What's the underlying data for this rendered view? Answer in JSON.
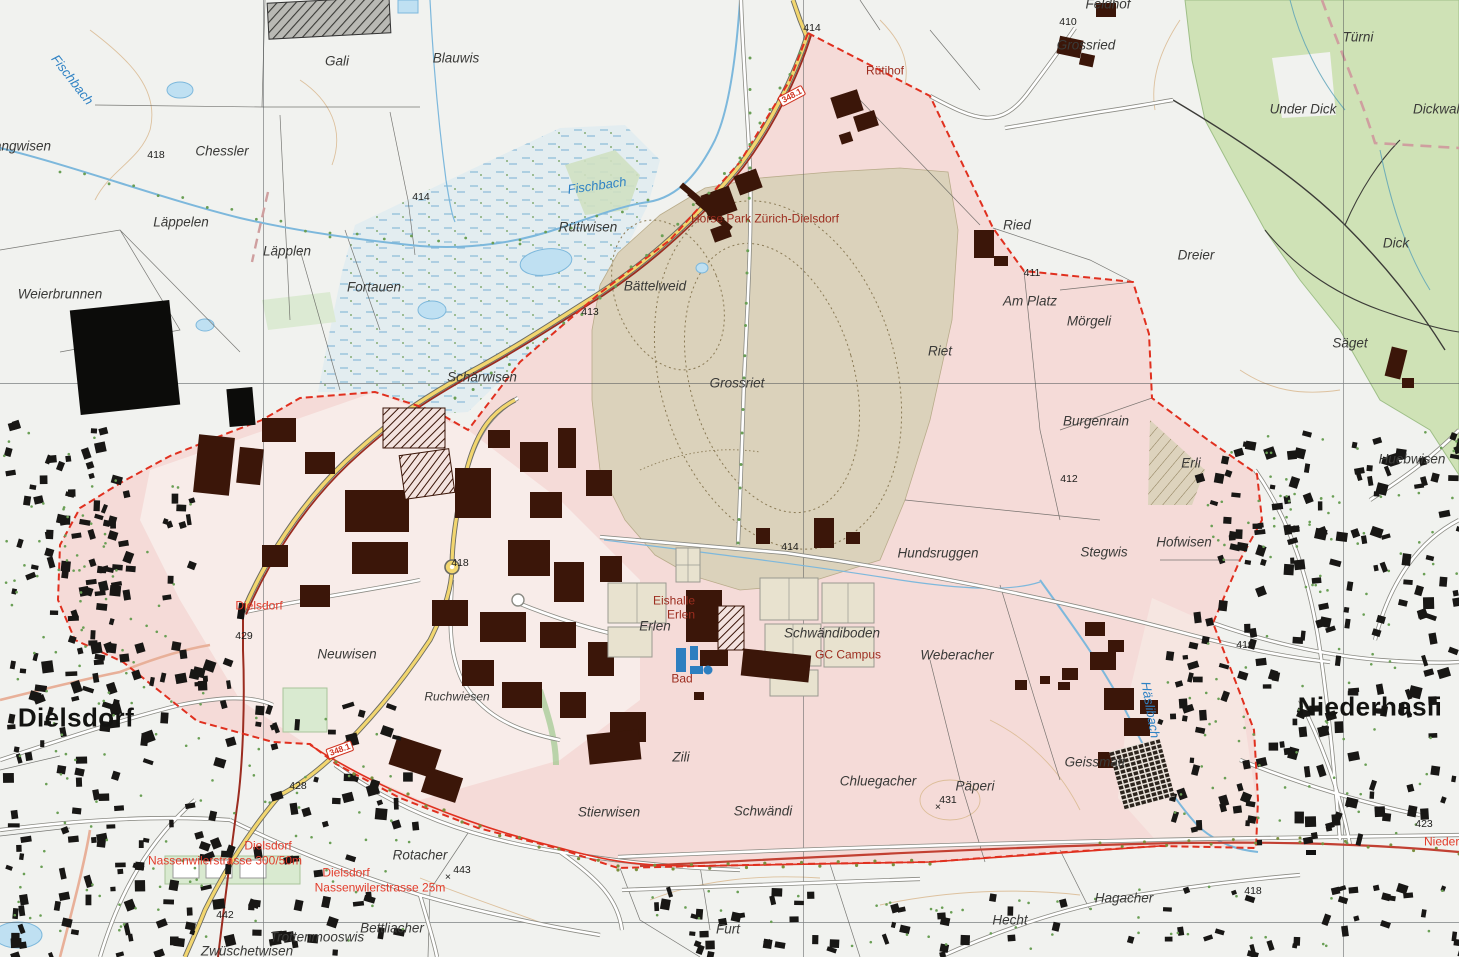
{
  "map": {
    "description": "Swiss national map extract, Dielsdorf / Niederhasli with development zone overlay",
    "colors": {
      "zone_pink": "#f5dbd8",
      "industrial_pink": "#f8ece9",
      "racetrack_tan": "#dbd2bb",
      "forest_green": "#cfe2b6",
      "marsh_blue": "#e3edf0",
      "water_blue": "#7db8dc",
      "building_town": "#181715",
      "building_industrial": "#3b1609",
      "boundary_red": "#e0301f",
      "railway_red": "#9b2c20",
      "road_yellow": "#f2d66f",
      "contour_brown": "#d9b98f",
      "tree_green": "#6a9f55",
      "label_water_blue": "#2f82c4",
      "label_poi_red": "#9c2d1f",
      "label_station_red": "#e23b2a"
    },
    "towns": [
      "Dielsdorf",
      "Niederhasli"
    ],
    "waters": [
      "Fischbach",
      "Häslibach"
    ],
    "pois": [
      "Horse Park Zürich-Dielsdorf",
      "Eishalle Erlen",
      "GC Campus",
      "Bad"
    ],
    "stations": [
      "Dielsdorf",
      "Dielsdorf Nassenwilerstrasse 300/50m",
      "Dielsdorf Nassenwilerstrasse 25m",
      "Niederhasli"
    ],
    "road_shield": "348.1"
  },
  "labels": [
    {
      "text": "angwisen",
      "x": -6,
      "y": 147,
      "cls": "field",
      "anchor": "left"
    },
    {
      "text": "Fischbach",
      "x": 72,
      "y": 80,
      "cls": "water",
      "rot": 52
    },
    {
      "text": "Gali",
      "x": 337,
      "y": 62,
      "cls": "field"
    },
    {
      "text": "Blauwis",
      "x": 456,
      "y": 59,
      "cls": "field"
    },
    {
      "text": "Chessler",
      "x": 222,
      "y": 152,
      "cls": "field"
    },
    {
      "text": "418",
      "x": 156,
      "y": 156,
      "cls": "elev"
    },
    {
      "text": "414",
      "x": 421,
      "y": 198,
      "cls": "elev"
    },
    {
      "text": "Läppelen",
      "x": 181,
      "y": 223,
      "cls": "field"
    },
    {
      "text": "Läpplen",
      "x": 287,
      "y": 252,
      "cls": "field"
    },
    {
      "text": "Weierbrunnen",
      "x": 60,
      "y": 295,
      "cls": "field"
    },
    {
      "text": "Fortauen",
      "x": 374,
      "y": 288,
      "cls": "field"
    },
    {
      "text": "Rütiwisen",
      "x": 588,
      "y": 228,
      "cls": "field"
    },
    {
      "text": "Fischbach",
      "x": 597,
      "y": 186,
      "cls": "water",
      "rot": -8
    },
    {
      "text": "Bättelweid",
      "x": 655,
      "y": 287,
      "cls": "field"
    },
    {
      "text": "413",
      "x": 590,
      "y": 313,
      "cls": "elev"
    },
    {
      "text": "Schärwisen",
      "x": 482,
      "y": 378,
      "cls": "field"
    },
    {
      "text": "Grossriet",
      "x": 737,
      "y": 384,
      "cls": "field"
    },
    {
      "text": "Riet",
      "x": 940,
      "y": 352,
      "cls": "field"
    },
    {
      "text": "Horse Park Zürich-Dielsdorf",
      "x": 765,
      "y": 219,
      "cls": "poi"
    },
    {
      "text": "Rütihof",
      "x": 885,
      "y": 71,
      "cls": "poi"
    },
    {
      "text": "414",
      "x": 812,
      "y": 29,
      "cls": "elev"
    },
    {
      "text": "348.1",
      "x": 792,
      "y": 96,
      "cls": "shield",
      "rot": -28
    },
    {
      "text": "348.1",
      "x": 340,
      "y": 750,
      "cls": "shield",
      "rot": -20
    },
    {
      "text": "410",
      "x": 1068,
      "y": 23,
      "cls": "elev"
    },
    {
      "text": "Grossried",
      "x": 1086,
      "y": 46,
      "cls": "field"
    },
    {
      "text": "Feldhof",
      "x": 1108,
      "y": 5,
      "cls": "field"
    },
    {
      "text": "Türni",
      "x": 1358,
      "y": 38,
      "cls": "field"
    },
    {
      "text": "Under Dick",
      "x": 1303,
      "y": 110,
      "cls": "field"
    },
    {
      "text": "Dickwald",
      "x": 1440,
      "y": 110,
      "cls": "field"
    },
    {
      "text": "Dreier",
      "x": 1196,
      "y": 256,
      "cls": "field"
    },
    {
      "text": "Dick",
      "x": 1396,
      "y": 244,
      "cls": "field"
    },
    {
      "text": "Ried",
      "x": 1017,
      "y": 226,
      "cls": "field"
    },
    {
      "text": "411",
      "x": 1032,
      "y": 274,
      "cls": "elev"
    },
    {
      "text": "Am Platz",
      "x": 1030,
      "y": 302,
      "cls": "field"
    },
    {
      "text": "Mörgeli",
      "x": 1089,
      "y": 322,
      "cls": "field"
    },
    {
      "text": "Säget",
      "x": 1350,
      "y": 344,
      "cls": "field"
    },
    {
      "text": "Burgenrain",
      "x": 1096,
      "y": 422,
      "cls": "field"
    },
    {
      "text": "Erli",
      "x": 1191,
      "y": 464,
      "cls": "field"
    },
    {
      "text": "412",
      "x": 1069,
      "y": 480,
      "cls": "elev"
    },
    {
      "text": "Huebwisen",
      "x": 1412,
      "y": 460,
      "cls": "field"
    },
    {
      "text": "Stegwis",
      "x": 1104,
      "y": 553,
      "cls": "field"
    },
    {
      "text": "Hofwisen",
      "x": 1184,
      "y": 543,
      "cls": "field"
    },
    {
      "text": "Hundsruggen",
      "x": 938,
      "y": 554,
      "cls": "field"
    },
    {
      "text": "Weberacher",
      "x": 957,
      "y": 656,
      "cls": "field"
    },
    {
      "text": "414",
      "x": 790,
      "y": 548,
      "cls": "elev"
    },
    {
      "text": "418",
      "x": 460,
      "y": 564,
      "cls": "elev"
    },
    {
      "text": "Eishalle",
      "x": 674,
      "y": 601,
      "cls": "poi"
    },
    {
      "text": "Erlen",
      "x": 681,
      "y": 615,
      "cls": "poi"
    },
    {
      "text": "Erlen",
      "x": 655,
      "y": 627,
      "cls": "field"
    },
    {
      "text": "Bad",
      "x": 682,
      "y": 679,
      "cls": "poi"
    },
    {
      "text": "Schwändiboden",
      "x": 832,
      "y": 634,
      "cls": "field"
    },
    {
      "text": "GC Campus",
      "x": 848,
      "y": 655,
      "cls": "poi"
    },
    {
      "text": "Neuwisen",
      "x": 347,
      "y": 655,
      "cls": "field"
    },
    {
      "text": "Dielsdorf",
      "x": 259,
      "y": 606,
      "cls": "station"
    },
    {
      "text": "429",
      "x": 244,
      "y": 637,
      "cls": "elev"
    },
    {
      "text": "Ruchwiesen",
      "x": 457,
      "y": 697,
      "cls": "field-sm"
    },
    {
      "text": "Dielsdorf",
      "x": 76,
      "y": 718,
      "cls": "town"
    },
    {
      "text": "Niederhasli",
      "x": 1370,
      "y": 707,
      "cls": "town"
    },
    {
      "text": "428",
      "x": 298,
      "y": 787,
      "cls": "elev"
    },
    {
      "text": "419",
      "x": 1245,
      "y": 646,
      "cls": "elev"
    },
    {
      "text": "Häslibach",
      "x": 1150,
      "y": 710,
      "cls": "water",
      "rot": 80
    },
    {
      "text": "Geissmatt",
      "x": 1095,
      "y": 763,
      "cls": "field"
    },
    {
      "text": "423",
      "x": 1424,
      "y": 825,
      "cls": "elev"
    },
    {
      "text": "Niederhasli",
      "x": 1424,
      "y": 842,
      "cls": "station",
      "anchor": "left"
    },
    {
      "text": "418",
      "x": 1253,
      "y": 892,
      "cls": "elev"
    },
    {
      "text": "Hagacher",
      "x": 1124,
      "y": 899,
      "cls": "field"
    },
    {
      "text": "Hecht",
      "x": 1010,
      "y": 921,
      "cls": "field"
    },
    {
      "text": "Furt",
      "x": 728,
      "y": 930,
      "cls": "field"
    },
    {
      "text": "Chluegacher",
      "x": 878,
      "y": 782,
      "cls": "field"
    },
    {
      "text": "Päperi",
      "x": 975,
      "y": 787,
      "cls": "field"
    },
    {
      "text": "431",
      "x": 948,
      "y": 801,
      "cls": "elev"
    },
    {
      "text": "×",
      "x": 938,
      "y": 808,
      "cls": "elev"
    },
    {
      "text": "Schwändi",
      "x": 763,
      "y": 812,
      "cls": "field"
    },
    {
      "text": "Stierwisen",
      "x": 609,
      "y": 813,
      "cls": "field"
    },
    {
      "text": "Zili",
      "x": 681,
      "y": 758,
      "cls": "field"
    },
    {
      "text": "Rotacher",
      "x": 420,
      "y": 856,
      "cls": "field"
    },
    {
      "text": "443",
      "x": 462,
      "y": 871,
      "cls": "elev"
    },
    {
      "text": "×",
      "x": 448,
      "y": 878,
      "cls": "elev"
    },
    {
      "text": "442",
      "x": 225,
      "y": 916,
      "cls": "elev"
    },
    {
      "text": "Bettliacher",
      "x": 392,
      "y": 929,
      "cls": "field"
    },
    {
      "text": "Trottenmooswis",
      "x": 317,
      "y": 938,
      "cls": "field"
    },
    {
      "text": "Zwüschetwisen",
      "x": 247,
      "y": 952,
      "cls": "field"
    },
    {
      "text": "Dielsdorf",
      "x": 268,
      "y": 846,
      "cls": "station"
    },
    {
      "text": "Nassenwilerstrasse 300/50m",
      "x": 225,
      "y": 861,
      "cls": "station"
    },
    {
      "text": "Dielsdorf",
      "x": 346,
      "y": 873,
      "cls": "station"
    },
    {
      "text": "Nassenwilerstrasse 25m",
      "x": 380,
      "y": 888,
      "cls": "station"
    }
  ]
}
